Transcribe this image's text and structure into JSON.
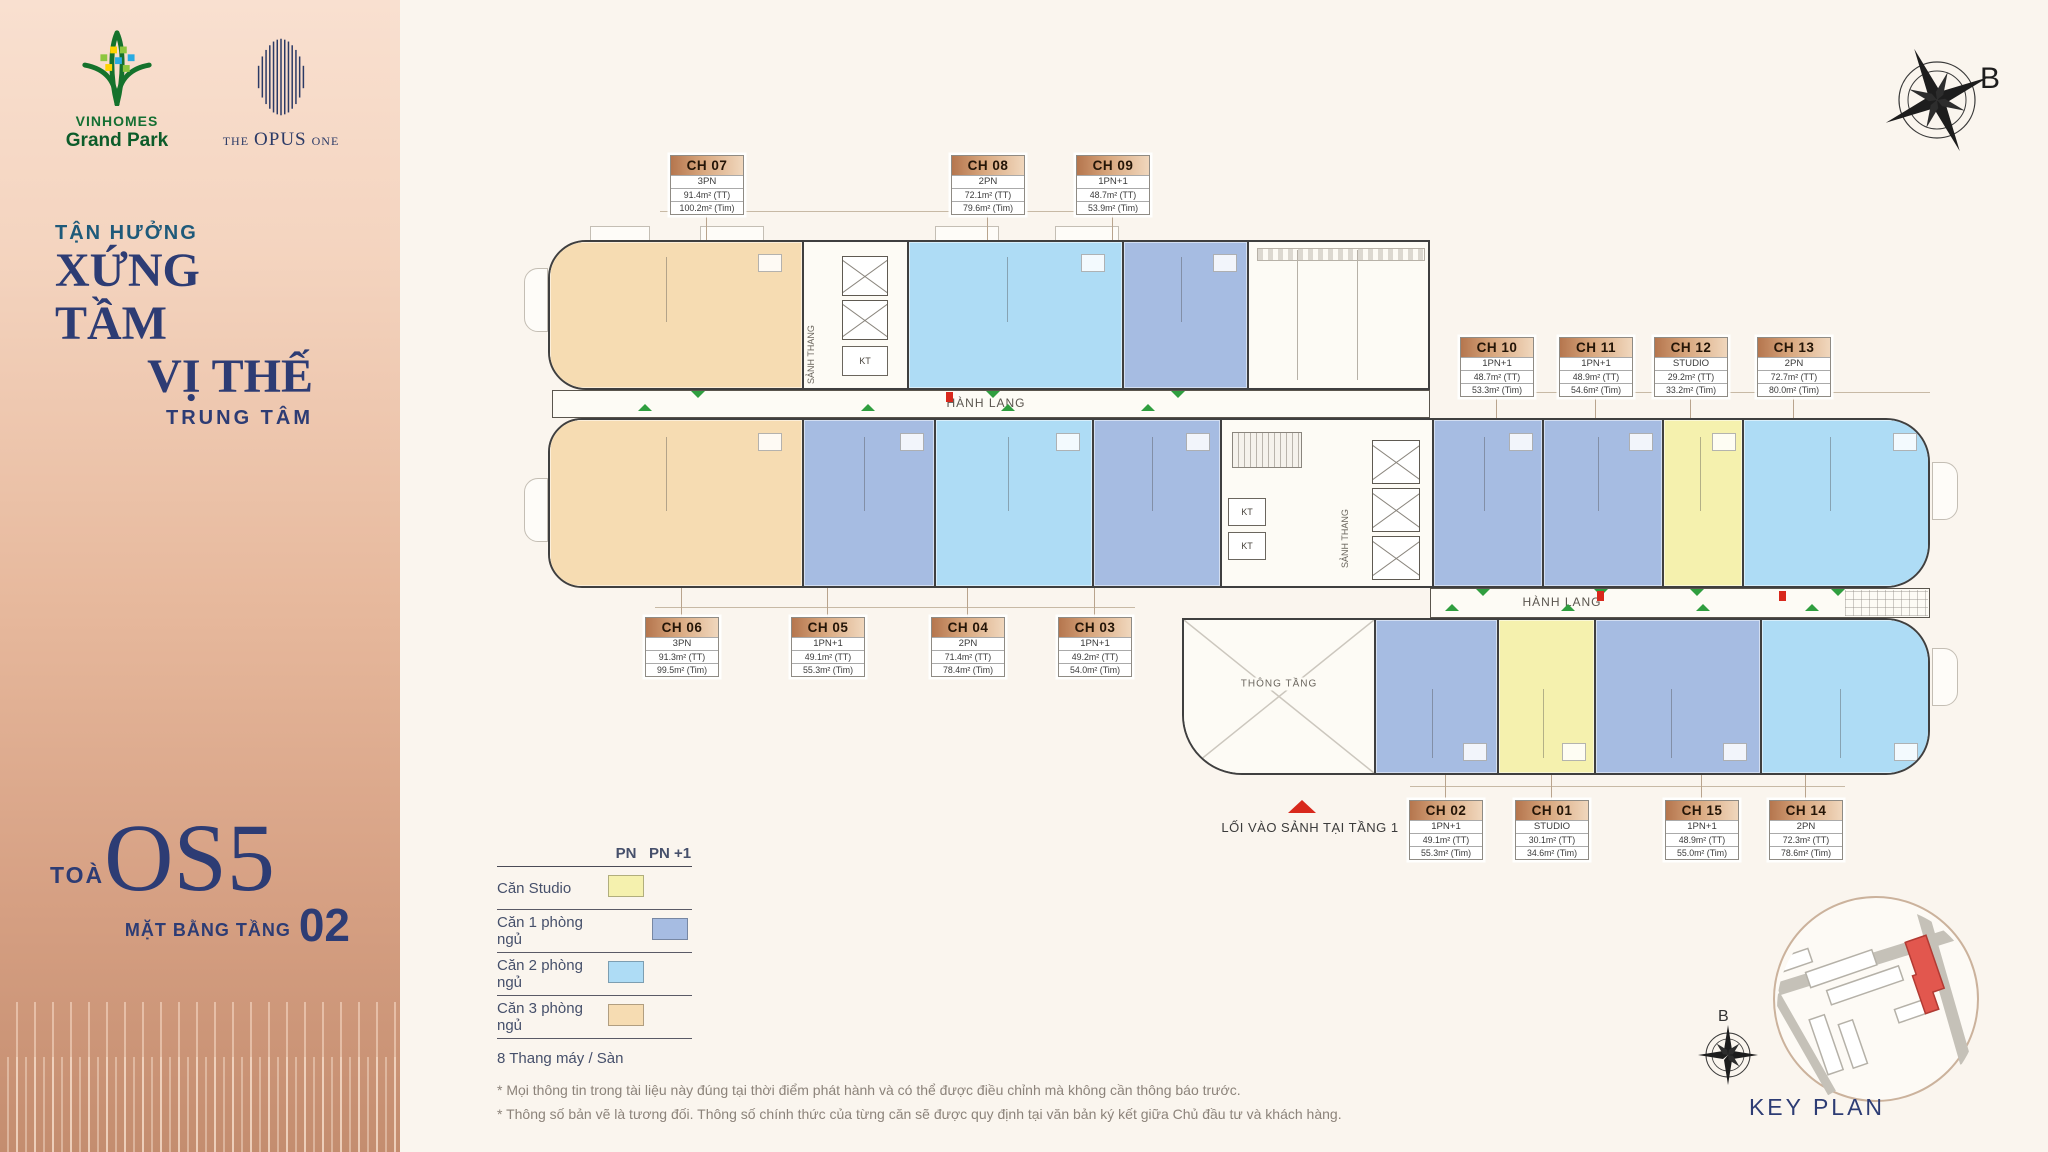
{
  "sidebar": {
    "vinhomes_logo": {
      "line1": "VINHOMES",
      "line2": "Grand Park"
    },
    "opus_logo": {
      "the": "THE",
      "opus": "OPUS",
      "one": "ONE"
    },
    "tagline": {
      "line1": "TẬN HƯỞNG",
      "line2": "XỨNG TẦM",
      "line3": "VỊ THẾ",
      "line4": "TRUNG TÂM"
    },
    "building": {
      "prefix": "TOÀ",
      "name": "OS5",
      "floor_label": "MẶT BẰNG TẦNG",
      "floor_number": "02"
    }
  },
  "compass": {
    "label": "B"
  },
  "plan": {
    "corridor_label": "HÀNH LANG",
    "stair_lobby_label": "SẢNH THANG",
    "void_label": "THÔNG TẦNG",
    "kt_label": "KT",
    "entrance_note": "LỐI VÀO SẢNH TẠI TẦNG 1"
  },
  "units": [
    {
      "label": "CH 01",
      "type": "STUDIO",
      "area_tt": "30.1m²  (TT)",
      "area_tim": "34.6m²  (Tim)",
      "category": "studio"
    },
    {
      "label": "CH 02",
      "type": "1PN+1",
      "area_tt": "49.1m²  (TT)",
      "area_tim": "55.3m²  (Tim)",
      "category": "one_bed"
    },
    {
      "label": "CH 03",
      "type": "1PN+1",
      "area_tt": "49.2m²  (TT)",
      "area_tim": "54.0m²  (Tim)",
      "category": "one_bed"
    },
    {
      "label": "CH 04",
      "type": "2PN",
      "area_tt": "71.4m²  (TT)",
      "area_tim": "78.4m²  (Tim)",
      "category": "two_bed"
    },
    {
      "label": "CH 05",
      "type": "1PN+1",
      "area_tt": "49.1m²  (TT)",
      "area_tim": "55.3m²  (Tim)",
      "category": "one_bed"
    },
    {
      "label": "CH 06",
      "type": "3PN",
      "area_tt": "91.3m²  (TT)",
      "area_tim": "99.5m²  (Tim)",
      "category": "three_bed"
    },
    {
      "label": "CH 07",
      "type": "3PN",
      "area_tt": "91.4m²  (TT)",
      "area_tim": "100.2m²  (Tim)",
      "category": "three_bed"
    },
    {
      "label": "CH 08",
      "type": "2PN",
      "area_tt": "72.1m²  (TT)",
      "area_tim": "79.6m²  (Tim)",
      "category": "two_bed"
    },
    {
      "label": "CH 09",
      "type": "1PN+1",
      "area_tt": "48.7m²  (TT)",
      "area_tim": "53.9m²  (Tim)",
      "category": "one_bed"
    },
    {
      "label": "CH 10",
      "type": "1PN+1",
      "area_tt": "48.7m²  (TT)",
      "area_tim": "53.3m²  (Tim)",
      "category": "one_bed"
    },
    {
      "label": "CH 11",
      "type": "1PN+1",
      "area_tt": "48.9m²  (TT)",
      "area_tim": "54.6m²  (Tim)",
      "category": "one_bed"
    },
    {
      "label": "CH 12",
      "type": "STUDIO",
      "area_tt": "29.2m²  (TT)",
      "area_tim": "33.2m²  (Tim)",
      "category": "studio"
    },
    {
      "label": "CH 13",
      "type": "2PN",
      "area_tt": "72.7m²  (TT)",
      "area_tim": "80.0m²  (Tim)",
      "category": "two_bed"
    },
    {
      "label": "CH 14",
      "type": "2PN",
      "area_tt": "72.3m²  (TT)",
      "area_tim": "78.6m²  (Tim)",
      "category": "two_bed"
    },
    {
      "label": "CH 15",
      "type": "1PN+1",
      "area_tt": "48.9m²  (TT)",
      "area_tim": "55.0m²  (Tim)",
      "category": "one_bed"
    }
  ],
  "legend": {
    "col_pn": "PN",
    "col_pn1": "PN +1",
    "rows": [
      {
        "label": "Căn Studio",
        "column": "pn",
        "category": "studio"
      },
      {
        "label": "Căn 1 phòng ngủ",
        "column": "pn1",
        "category": "one_bed"
      },
      {
        "label": "Căn 2 phòng ngủ",
        "column": "pn",
        "category": "two_bed"
      },
      {
        "label": "Căn 3 phòng ngủ",
        "column": "pn",
        "category": "three_bed"
      }
    ],
    "elevators_note": "8 Thang máy / Sàn"
  },
  "footnotes": [
    "* Mọi thông tin trong tài liệu này đúng tại thời điểm phát hành và có thể được điều chỉnh mà không cần thông báo trước.",
    "* Thông số bản vẽ là tương đối. Thông số chính thức của từng căn sẽ được quy định tại văn bản ký kết giữa Chủ đầu tư và khách hàng."
  ],
  "keyplan": {
    "title": "KEY PLAN",
    "compass_label": "B"
  },
  "colors": {
    "studio": "#f5f1ae",
    "one_bed": "#a6bce2",
    "two_bed": "#aedcf5",
    "three_bed": "#f6dcb2",
    "accent_red": "#d8281c",
    "navy": "#2d3c74"
  }
}
